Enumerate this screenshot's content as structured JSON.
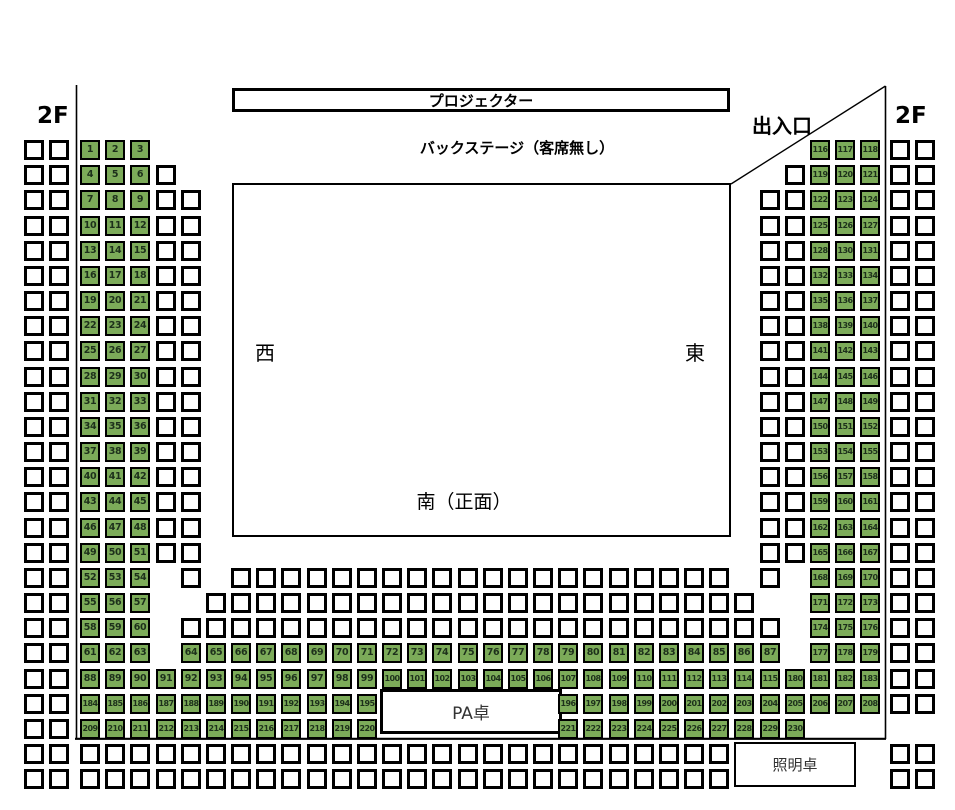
{
  "labels": {
    "projector": "プロジェクター",
    "backstage": "バックステージ（客席無し）",
    "floor_left": "2F",
    "floor_right": "2F",
    "entrance": "出入口",
    "stage_west": "西",
    "stage_east": "東",
    "stage_south": "南（正面）",
    "pa_desk": "PA卓",
    "lighting_desk": "照明卓"
  },
  "colors": {
    "seat_green": "#7cab59",
    "seat_border": "#000000",
    "line": "#000000"
  },
  "seat_map": {
    "rows": [
      {
        "j": 0,
        "runs": [
          {
            "c": -2,
            "t": "w",
            "len": 2
          },
          {
            "c": 0,
            "t": "g",
            "from": 1,
            "to": 3
          },
          {
            "c": 29,
            "t": "g",
            "from": 116,
            "to": 118
          },
          {
            "c": 32,
            "t": "w",
            "len": 2
          }
        ]
      },
      {
        "j": 1,
        "runs": [
          {
            "c": -2,
            "t": "w",
            "len": 2
          },
          {
            "c": 0,
            "t": "g",
            "from": 4,
            "to": 6
          },
          {
            "c": 3,
            "t": "w",
            "len": 1
          },
          {
            "c": 28,
            "t": "w",
            "len": 1
          },
          {
            "c": 29,
            "t": "g",
            "from": 119,
            "to": 121
          },
          {
            "c": 32,
            "t": "w",
            "len": 2
          }
        ]
      },
      {
        "j": 2,
        "runs": [
          {
            "c": -2,
            "t": "w",
            "len": 2
          },
          {
            "c": 0,
            "t": "g",
            "from": 7,
            "to": 9
          },
          {
            "c": 3,
            "t": "w",
            "len": 2
          },
          {
            "c": 27,
            "t": "w",
            "len": 2
          },
          {
            "c": 29,
            "t": "g",
            "from": 122,
            "to": 124
          },
          {
            "c": 32,
            "t": "w",
            "len": 2
          }
        ]
      },
      {
        "j": 3,
        "runs": [
          {
            "c": -2,
            "t": "w",
            "len": 2
          },
          {
            "c": 0,
            "t": "g",
            "from": 10,
            "to": 12
          },
          {
            "c": 3,
            "t": "w",
            "len": 2
          },
          {
            "c": 27,
            "t": "w",
            "len": 2
          },
          {
            "c": 29,
            "t": "g",
            "from": 125,
            "to": 127
          },
          {
            "c": 32,
            "t": "w",
            "len": 2
          }
        ]
      },
      {
        "j": 4,
        "runs": [
          {
            "c": -2,
            "t": "w",
            "len": 2
          },
          {
            "c": 0,
            "t": "g",
            "from": 13,
            "to": 15
          },
          {
            "c": 3,
            "t": "w",
            "len": 2
          },
          {
            "c": 27,
            "t": "w",
            "len": 2
          },
          {
            "c": 29,
            "t": "g",
            "nums": [
              128,
              130,
              131
            ]
          },
          {
            "c": 32,
            "t": "w",
            "len": 2
          }
        ]
      },
      {
        "j": 5,
        "runs": [
          {
            "c": -2,
            "t": "w",
            "len": 2
          },
          {
            "c": 0,
            "t": "g",
            "from": 16,
            "to": 18
          },
          {
            "c": 3,
            "t": "w",
            "len": 2
          },
          {
            "c": 27,
            "t": "w",
            "len": 2
          },
          {
            "c": 29,
            "t": "g",
            "from": 132,
            "to": 134
          },
          {
            "c": 32,
            "t": "w",
            "len": 2
          }
        ]
      },
      {
        "j": 6,
        "runs": [
          {
            "c": -2,
            "t": "w",
            "len": 2
          },
          {
            "c": 0,
            "t": "g",
            "from": 19,
            "to": 21
          },
          {
            "c": 3,
            "t": "w",
            "len": 2
          },
          {
            "c": 27,
            "t": "w",
            "len": 2
          },
          {
            "c": 29,
            "t": "g",
            "from": 135,
            "to": 137
          },
          {
            "c": 32,
            "t": "w",
            "len": 2
          }
        ]
      },
      {
        "j": 7,
        "runs": [
          {
            "c": -2,
            "t": "w",
            "len": 2
          },
          {
            "c": 0,
            "t": "g",
            "from": 22,
            "to": 24
          },
          {
            "c": 3,
            "t": "w",
            "len": 2
          },
          {
            "c": 27,
            "t": "w",
            "len": 2
          },
          {
            "c": 29,
            "t": "g",
            "from": 138,
            "to": 140
          },
          {
            "c": 32,
            "t": "w",
            "len": 2
          }
        ]
      },
      {
        "j": 8,
        "runs": [
          {
            "c": -2,
            "t": "w",
            "len": 2
          },
          {
            "c": 0,
            "t": "g",
            "from": 25,
            "to": 27
          },
          {
            "c": 3,
            "t": "w",
            "len": 2
          },
          {
            "c": 27,
            "t": "w",
            "len": 2
          },
          {
            "c": 29,
            "t": "g",
            "from": 141,
            "to": 143
          },
          {
            "c": 32,
            "t": "w",
            "len": 2
          }
        ]
      },
      {
        "j": 9,
        "runs": [
          {
            "c": -2,
            "t": "w",
            "len": 2
          },
          {
            "c": 0,
            "t": "g",
            "from": 28,
            "to": 30
          },
          {
            "c": 3,
            "t": "w",
            "len": 2
          },
          {
            "c": 27,
            "t": "w",
            "len": 2
          },
          {
            "c": 29,
            "t": "g",
            "from": 144,
            "to": 146
          },
          {
            "c": 32,
            "t": "w",
            "len": 2
          }
        ]
      },
      {
        "j": 10,
        "runs": [
          {
            "c": -2,
            "t": "w",
            "len": 2
          },
          {
            "c": 0,
            "t": "g",
            "from": 31,
            "to": 33
          },
          {
            "c": 3,
            "t": "w",
            "len": 2
          },
          {
            "c": 27,
            "t": "w",
            "len": 2
          },
          {
            "c": 29,
            "t": "g",
            "from": 147,
            "to": 149
          },
          {
            "c": 32,
            "t": "w",
            "len": 2
          }
        ]
      },
      {
        "j": 11,
        "runs": [
          {
            "c": -2,
            "t": "w",
            "len": 2
          },
          {
            "c": 0,
            "t": "g",
            "from": 34,
            "to": 36
          },
          {
            "c": 3,
            "t": "w",
            "len": 2
          },
          {
            "c": 27,
            "t": "w",
            "len": 2
          },
          {
            "c": 29,
            "t": "g",
            "from": 150,
            "to": 152
          },
          {
            "c": 32,
            "t": "w",
            "len": 2
          }
        ]
      },
      {
        "j": 12,
        "runs": [
          {
            "c": -2,
            "t": "w",
            "len": 2
          },
          {
            "c": 0,
            "t": "g",
            "from": 37,
            "to": 39
          },
          {
            "c": 3,
            "t": "w",
            "len": 2
          },
          {
            "c": 27,
            "t": "w",
            "len": 2
          },
          {
            "c": 29,
            "t": "g",
            "from": 153,
            "to": 155
          },
          {
            "c": 32,
            "t": "w",
            "len": 2
          }
        ]
      },
      {
        "j": 13,
        "runs": [
          {
            "c": -2,
            "t": "w",
            "len": 2
          },
          {
            "c": 0,
            "t": "g",
            "from": 40,
            "to": 42
          },
          {
            "c": 3,
            "t": "w",
            "len": 2
          },
          {
            "c": 27,
            "t": "w",
            "len": 2
          },
          {
            "c": 29,
            "t": "g",
            "from": 156,
            "to": 158
          },
          {
            "c": 32,
            "t": "w",
            "len": 2
          }
        ]
      },
      {
        "j": 14,
        "runs": [
          {
            "c": -2,
            "t": "w",
            "len": 2
          },
          {
            "c": 0,
            "t": "g",
            "from": 43,
            "to": 45
          },
          {
            "c": 3,
            "t": "w",
            "len": 2
          },
          {
            "c": 27,
            "t": "w",
            "len": 2
          },
          {
            "c": 29,
            "t": "g",
            "from": 159,
            "to": 161
          },
          {
            "c": 32,
            "t": "w",
            "len": 2
          }
        ]
      },
      {
        "j": 15,
        "runs": [
          {
            "c": -2,
            "t": "w",
            "len": 2
          },
          {
            "c": 0,
            "t": "g",
            "from": 46,
            "to": 48
          },
          {
            "c": 3,
            "t": "w",
            "len": 2
          },
          {
            "c": 27,
            "t": "w",
            "len": 2
          },
          {
            "c": 29,
            "t": "g",
            "from": 162,
            "to": 164
          },
          {
            "c": 32,
            "t": "w",
            "len": 2
          }
        ]
      },
      {
        "j": 16,
        "runs": [
          {
            "c": -2,
            "t": "w",
            "len": 2
          },
          {
            "c": 0,
            "t": "g",
            "from": 49,
            "to": 51
          },
          {
            "c": 3,
            "t": "w",
            "len": 2
          },
          {
            "c": 27,
            "t": "w",
            "len": 2
          },
          {
            "c": 29,
            "t": "g",
            "from": 165,
            "to": 167
          },
          {
            "c": 32,
            "t": "w",
            "len": 2
          }
        ]
      },
      {
        "j": 17,
        "runs": [
          {
            "c": -2,
            "t": "w",
            "len": 2
          },
          {
            "c": 0,
            "t": "g",
            "from": 52,
            "to": 54
          },
          {
            "c": 4,
            "t": "w",
            "len": 1
          },
          {
            "c": 6,
            "t": "w",
            "len": 20
          },
          {
            "c": 27,
            "t": "w",
            "len": 1
          },
          {
            "c": 29,
            "t": "g",
            "from": 168,
            "to": 170
          },
          {
            "c": 32,
            "t": "w",
            "len": 2
          }
        ]
      },
      {
        "j": 18,
        "runs": [
          {
            "c": -2,
            "t": "w",
            "len": 2
          },
          {
            "c": 0,
            "t": "g",
            "from": 55,
            "to": 57
          },
          {
            "c": 5,
            "t": "w",
            "len": 22
          },
          {
            "c": 29,
            "t": "g",
            "from": 171,
            "to": 173
          },
          {
            "c": 32,
            "t": "w",
            "len": 2
          }
        ]
      },
      {
        "j": 19,
        "runs": [
          {
            "c": -2,
            "t": "w",
            "len": 2
          },
          {
            "c": 0,
            "t": "g",
            "from": 58,
            "to": 60
          },
          {
            "c": 4,
            "t": "w",
            "len": 24
          },
          {
            "c": 29,
            "t": "g",
            "from": 174,
            "to": 176
          },
          {
            "c": 32,
            "t": "w",
            "len": 2
          }
        ]
      },
      {
        "j": 20,
        "runs": [
          {
            "c": -2,
            "t": "w",
            "len": 2
          },
          {
            "c": 0,
            "t": "g",
            "from": 61,
            "to": 63
          },
          {
            "c": 4,
            "t": "g",
            "from": 64,
            "to": 87
          },
          {
            "c": 29,
            "t": "g",
            "from": 177,
            "to": 179
          },
          {
            "c": 32,
            "t": "w",
            "len": 2
          }
        ]
      },
      {
        "j": 21,
        "runs": [
          {
            "c": -2,
            "t": "w",
            "len": 2
          },
          {
            "c": 0,
            "t": "g",
            "from": 88,
            "to": 91
          },
          {
            "c": 4,
            "t": "g",
            "from": 92,
            "to": 115
          },
          {
            "c": 28,
            "t": "g",
            "from": 180,
            "to": 183
          },
          {
            "c": 32,
            "t": "w",
            "len": 2
          }
        ]
      },
      {
        "j": 22,
        "runs": [
          {
            "c": -2,
            "t": "w",
            "len": 2
          },
          {
            "c": 0,
            "t": "g",
            "from": 184,
            "to": 187
          },
          {
            "c": 4,
            "t": "g",
            "from": 188,
            "to": 195
          },
          {
            "c": 19,
            "t": "g",
            "from": 196,
            "to": 208
          },
          {
            "c": 32,
            "t": "w",
            "len": 2
          }
        ]
      },
      {
        "j": 23,
        "runs": [
          {
            "c": -2,
            "t": "w",
            "len": 2
          },
          {
            "c": 0,
            "t": "g",
            "from": 209,
            "to": 212
          },
          {
            "c": 4,
            "t": "g",
            "from": 213,
            "to": 220
          },
          {
            "c": 19,
            "t": "g",
            "from": 221,
            "to": 230
          }
        ]
      },
      {
        "j": 24,
        "runs": [
          {
            "c": -2,
            "t": "w",
            "len": 2
          },
          {
            "c": 0,
            "t": "w",
            "len": 26
          },
          {
            "c": 32,
            "t": "w",
            "len": 2
          }
        ]
      },
      {
        "j": 25,
        "runs": [
          {
            "c": -2,
            "t": "w",
            "len": 2
          },
          {
            "c": 0,
            "t": "w",
            "len": 26
          },
          {
            "c": 32,
            "t": "w",
            "len": 2
          }
        ]
      }
    ]
  }
}
